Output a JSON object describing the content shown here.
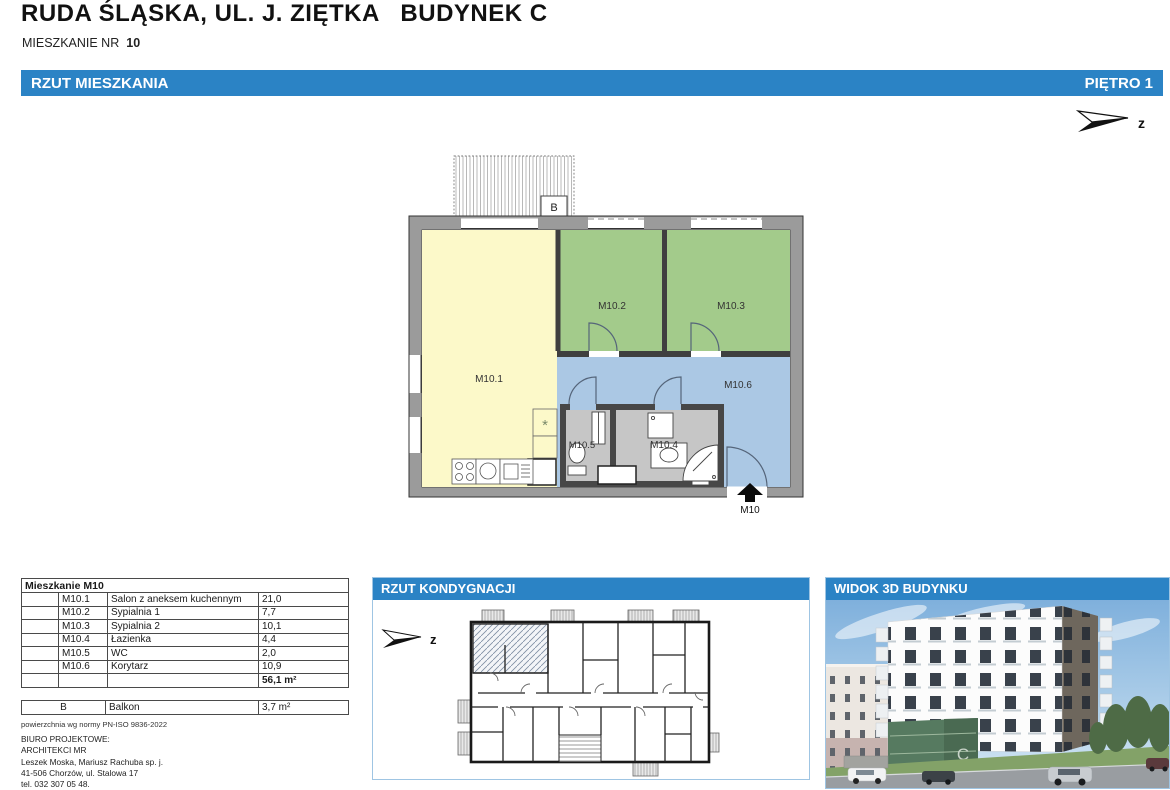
{
  "document": {
    "title": "RUDA ŚLĄSKA, UL. J. ZIĘTKA   BUDYNEK C",
    "subtitle_label": "MIESZKANIE NR",
    "subtitle_number": "10"
  },
  "top_bar": {
    "left": "RZUT MIESZKANIA",
    "right": "PIĘTRO 1"
  },
  "north_arrow": {
    "label": "z"
  },
  "floor_plan": {
    "room_labels": [
      "M10.1",
      "M10.2",
      "M10.3",
      "M10.4",
      "M10.5",
      "M10.6"
    ],
    "balcony_label": "B",
    "entrance_label": "M10",
    "kitchen_symbol": "*"
  },
  "area_table": {
    "title": "Mieszkanie M10",
    "rows": [
      {
        "code": "M10.1",
        "name": "Salon z aneksem kuchennym",
        "area": "21,0"
      },
      {
        "code": "M10.2",
        "name": "Sypialnia 1",
        "area": "7,7"
      },
      {
        "code": "M10.3",
        "name": "Sypialnia 2",
        "area": "10,1"
      },
      {
        "code": "M10.4",
        "name": "Łazienka",
        "area": "4,4"
      },
      {
        "code": "M10.5",
        "name": "WC",
        "area": "2,0"
      },
      {
        "code": "M10.6",
        "name": "Korytarz",
        "area": "10,9"
      }
    ],
    "total": "56,1 m²"
  },
  "balcony_table": {
    "code": "B",
    "name": "Balkon",
    "area": "3,7 m²"
  },
  "norm_note": "powierzchnia wg normy PN-ISO 9836-2022",
  "office": {
    "label": "BIURO PROJEKTOWE:",
    "name": "ARCHITEKCI MR",
    "partners": "Leszek Moska, Mariusz Rachuba sp. j.",
    "address": "41-506 Chorzów, ul. Stalowa 17",
    "phone": "tel. 032 307 05 48."
  },
  "panels": {
    "floor_layout": {
      "title": "RZUT KONDYGNACJI",
      "north_label": "z"
    },
    "view_3d": {
      "title": "WIDOK 3D BUDYNKU",
      "building_letter": "C"
    }
  },
  "colors": {
    "accent_blue": "#2b83c5",
    "room_yellow": "#fcf9c9",
    "room_green": "#a3cb8b",
    "room_blue": "#abc8e4",
    "room_gray": "#c6c6c6"
  }
}
